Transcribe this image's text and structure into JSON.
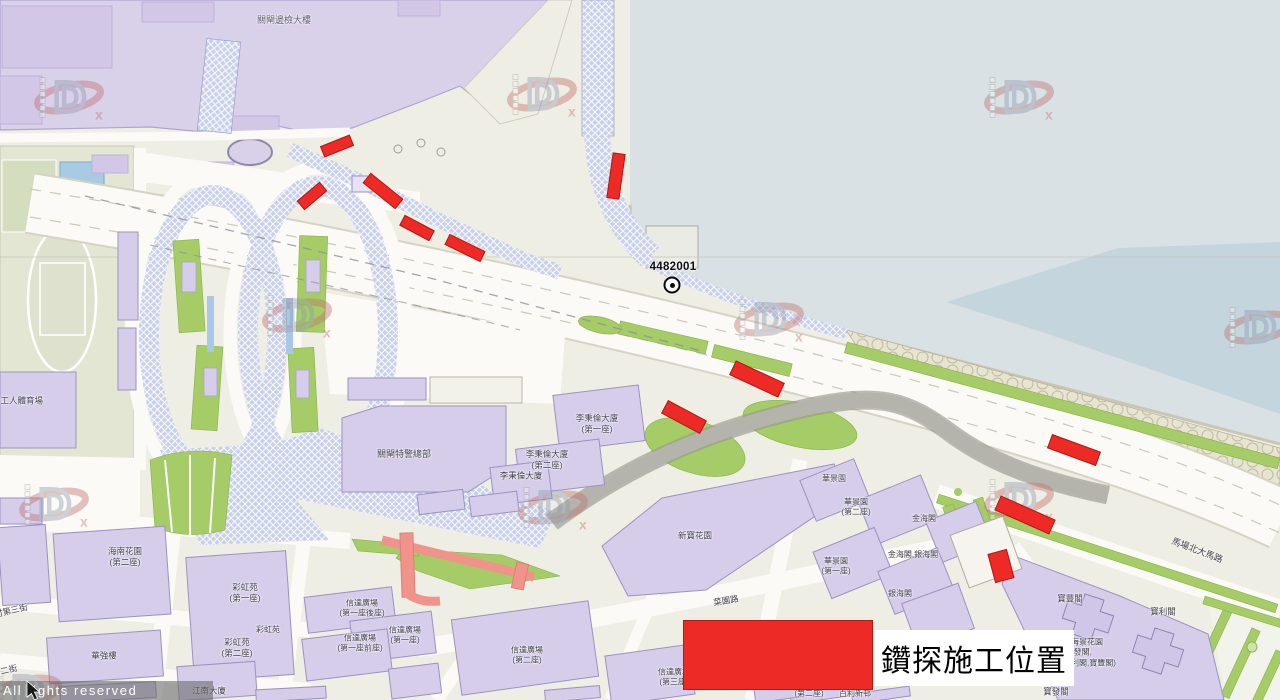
{
  "colors": {
    "drill_red": "#ee2a26",
    "drill_red_border": "#b01b15",
    "water": "#d9e1e5",
    "water_deep": "#c5d5dd",
    "cross_border_zone": "#d9d0ea",
    "building": "#d6cdeb",
    "green": "#a5cc66",
    "label": "#3e3d48"
  },
  "legend": {
    "label": "鑽探施工位置"
  },
  "borehole": {
    "id": "4482001"
  },
  "watermark": {
    "rights_text": "All rights reserved"
  },
  "map_labels": [
    {
      "name": "border-checkpoint-building",
      "text": "關閘邊檢大樓",
      "x": 284,
      "y": 21,
      "fs": 9,
      "color": "#5c5a6e"
    },
    {
      "name": "workers-stadium",
      "text": "會工人體育場",
      "x": -8,
      "y": 401,
      "fs": 8.5,
      "align": "left"
    },
    {
      "name": "police-hq",
      "text": "關閘特警總部",
      "x": 404,
      "y": 455,
      "fs": 9
    },
    {
      "name": "lei-peng-lon-1",
      "text": "李秉倫大廈\n(第一座)",
      "x": 597,
      "y": 424,
      "fs": 8.5
    },
    {
      "name": "lei-peng-lon-2",
      "text": "李秉倫大廈\n(第二座)",
      "x": 547,
      "y": 460,
      "fs": 8.5
    },
    {
      "name": "lei-peng-lon-3",
      "text": "李秉倫大廈",
      "x": 521,
      "y": 476,
      "fs": 8.5
    },
    {
      "name": "hoi-nam-garden",
      "text": "海南花園\n(第二座)",
      "x": 125,
      "y": 557,
      "fs": 8.5
    },
    {
      "name": "choi-hong-court-1",
      "text": "彩虹苑\n(第一座)",
      "x": 245,
      "y": 593,
      "fs": 8.5
    },
    {
      "name": "choi-hong-court",
      "text": "彩虹苑",
      "x": 268,
      "y": 630,
      "fs": 8
    },
    {
      "name": "choi-hong-court-2",
      "text": "彩虹苑\n(第二座)",
      "x": 237,
      "y": 648,
      "fs": 8.5
    },
    {
      "name": "wa-keong-lau",
      "text": "華強樓",
      "x": 104,
      "y": 656,
      "fs": 8.5
    },
    {
      "name": "kong-nam-building",
      "text": "江南大廈",
      "x": 209,
      "y": 691,
      "fs": 8.5
    },
    {
      "name": "son-tat-plaza-1-back",
      "text": "信達廣場\n(第一座後座)",
      "x": 362,
      "y": 609,
      "fs": 8
    },
    {
      "name": "son-tat-plaza-1-front",
      "text": "信達廣場\n(第一座前座)",
      "x": 360,
      "y": 644,
      "fs": 8
    },
    {
      "name": "son-tat-plaza-1",
      "text": "信達廣場\n(第一座)",
      "x": 405,
      "y": 636,
      "fs": 8
    },
    {
      "name": "son-tat-plaza-2",
      "text": "信達廣場\n(第二座)",
      "x": 527,
      "y": 656,
      "fs": 8
    },
    {
      "name": "son-tat-plaza-3",
      "text": "信達廣場\n(第三座)",
      "x": 674,
      "y": 678,
      "fs": 8
    },
    {
      "name": "block-2-label",
      "text": "(第二座)",
      "x": 809,
      "y": 694,
      "fs": 8
    },
    {
      "name": "pak-lei-estate",
      "text": "百利新邨",
      "x": 855,
      "y": 694,
      "fs": 8
    },
    {
      "name": "san-pou-garden",
      "text": "新寶花園",
      "x": 695,
      "y": 536,
      "fs": 8.5
    },
    {
      "name": "choi-un-road",
      "text": "菜園路",
      "x": 726,
      "y": 601,
      "rot": -10,
      "fs": 8.5
    },
    {
      "name": "wa-keng-garden",
      "text": "華景園",
      "x": 834,
      "y": 479,
      "fs": 8
    },
    {
      "name": "wa-keng-garden-2",
      "text": "華景園\n(第二座)",
      "x": 856,
      "y": 508,
      "fs": 8
    },
    {
      "name": "kam-hoi-court",
      "text": "金海閣",
      "x": 924,
      "y": 519,
      "fs": 8
    },
    {
      "name": "wa-keng-garden-1",
      "text": "華景園\n(第一座)",
      "x": 836,
      "y": 567,
      "fs": 8
    },
    {
      "name": "kam-hoi-ngan-hoi",
      "text": "金海閣,銀海閣",
      "x": 913,
      "y": 555,
      "fs": 8
    },
    {
      "name": "ngan-hoi-court",
      "text": "銀海閣",
      "x": 900,
      "y": 594,
      "fs": 8
    },
    {
      "name": "pou-fong-court",
      "text": "寶豐閣",
      "x": 1070,
      "y": 599,
      "fs": 8.5
    },
    {
      "name": "pou-lei-court",
      "text": "寶利閣",
      "x": 1163,
      "y": 612,
      "fs": 8.5
    },
    {
      "name": "bin-hoi-keng-garden",
      "text": "濱海景花園\n(寶發閣,\n寶利閣,寶豐閣)",
      "x": 1063,
      "y": 653,
      "fs": 8,
      "align": "left"
    },
    {
      "name": "pou-fat-court",
      "text": "寶發閣",
      "x": 1056,
      "y": 692,
      "fs": 8.5
    },
    {
      "name": "ma-cheong-north-road",
      "text": "馬場北大馬路",
      "x": 1197,
      "y": 551,
      "rot": 21,
      "fs": 9
    },
    {
      "name": "street-third",
      "text": "村第三街",
      "x": -6,
      "y": 611,
      "rot": -13,
      "fs": 8.5,
      "align": "left"
    },
    {
      "name": "street-second",
      "text": "第二街",
      "x": -8,
      "y": 671,
      "rot": -13,
      "fs": 8.5,
      "align": "left"
    }
  ],
  "drill_markers": [
    {
      "x": 337,
      "y": 146,
      "w": 32,
      "h": 12,
      "rot": -22
    },
    {
      "x": 312,
      "y": 196,
      "w": 30,
      "h": 12,
      "rot": -40
    },
    {
      "x": 383,
      "y": 191,
      "w": 42,
      "h": 13,
      "rot": 39
    },
    {
      "x": 417,
      "y": 228,
      "w": 34,
      "h": 12,
      "rot": 28
    },
    {
      "x": 465,
      "y": 248,
      "w": 40,
      "h": 12,
      "rot": 26
    },
    {
      "x": 616,
      "y": 176,
      "w": 13,
      "h": 46,
      "rot": 8
    },
    {
      "x": 757,
      "y": 379,
      "w": 54,
      "h": 16,
      "rot": 25
    },
    {
      "x": 684,
      "y": 417,
      "w": 44,
      "h": 15,
      "rot": 28
    },
    {
      "x": 1074,
      "y": 450,
      "w": 52,
      "h": 15,
      "rot": 20
    },
    {
      "x": 1025,
      "y": 515,
      "w": 60,
      "h": 16,
      "rot": 24
    },
    {
      "x": 1001,
      "y": 566,
      "w": 20,
      "h": 30,
      "rot": -15
    }
  ],
  "watermarks": [
    {
      "x": 72,
      "y": 100
    },
    {
      "x": 545,
      "y": 97
    },
    {
      "x": 1022,
      "y": 100
    },
    {
      "x": 300,
      "y": 318
    },
    {
      "x": 772,
      "y": 322
    },
    {
      "x": 1262,
      "y": 330
    },
    {
      "x": 57,
      "y": 507
    },
    {
      "x": 556,
      "y": 510
    },
    {
      "x": 1022,
      "y": 502
    },
    {
      "x": 30,
      "y": 694
    }
  ]
}
